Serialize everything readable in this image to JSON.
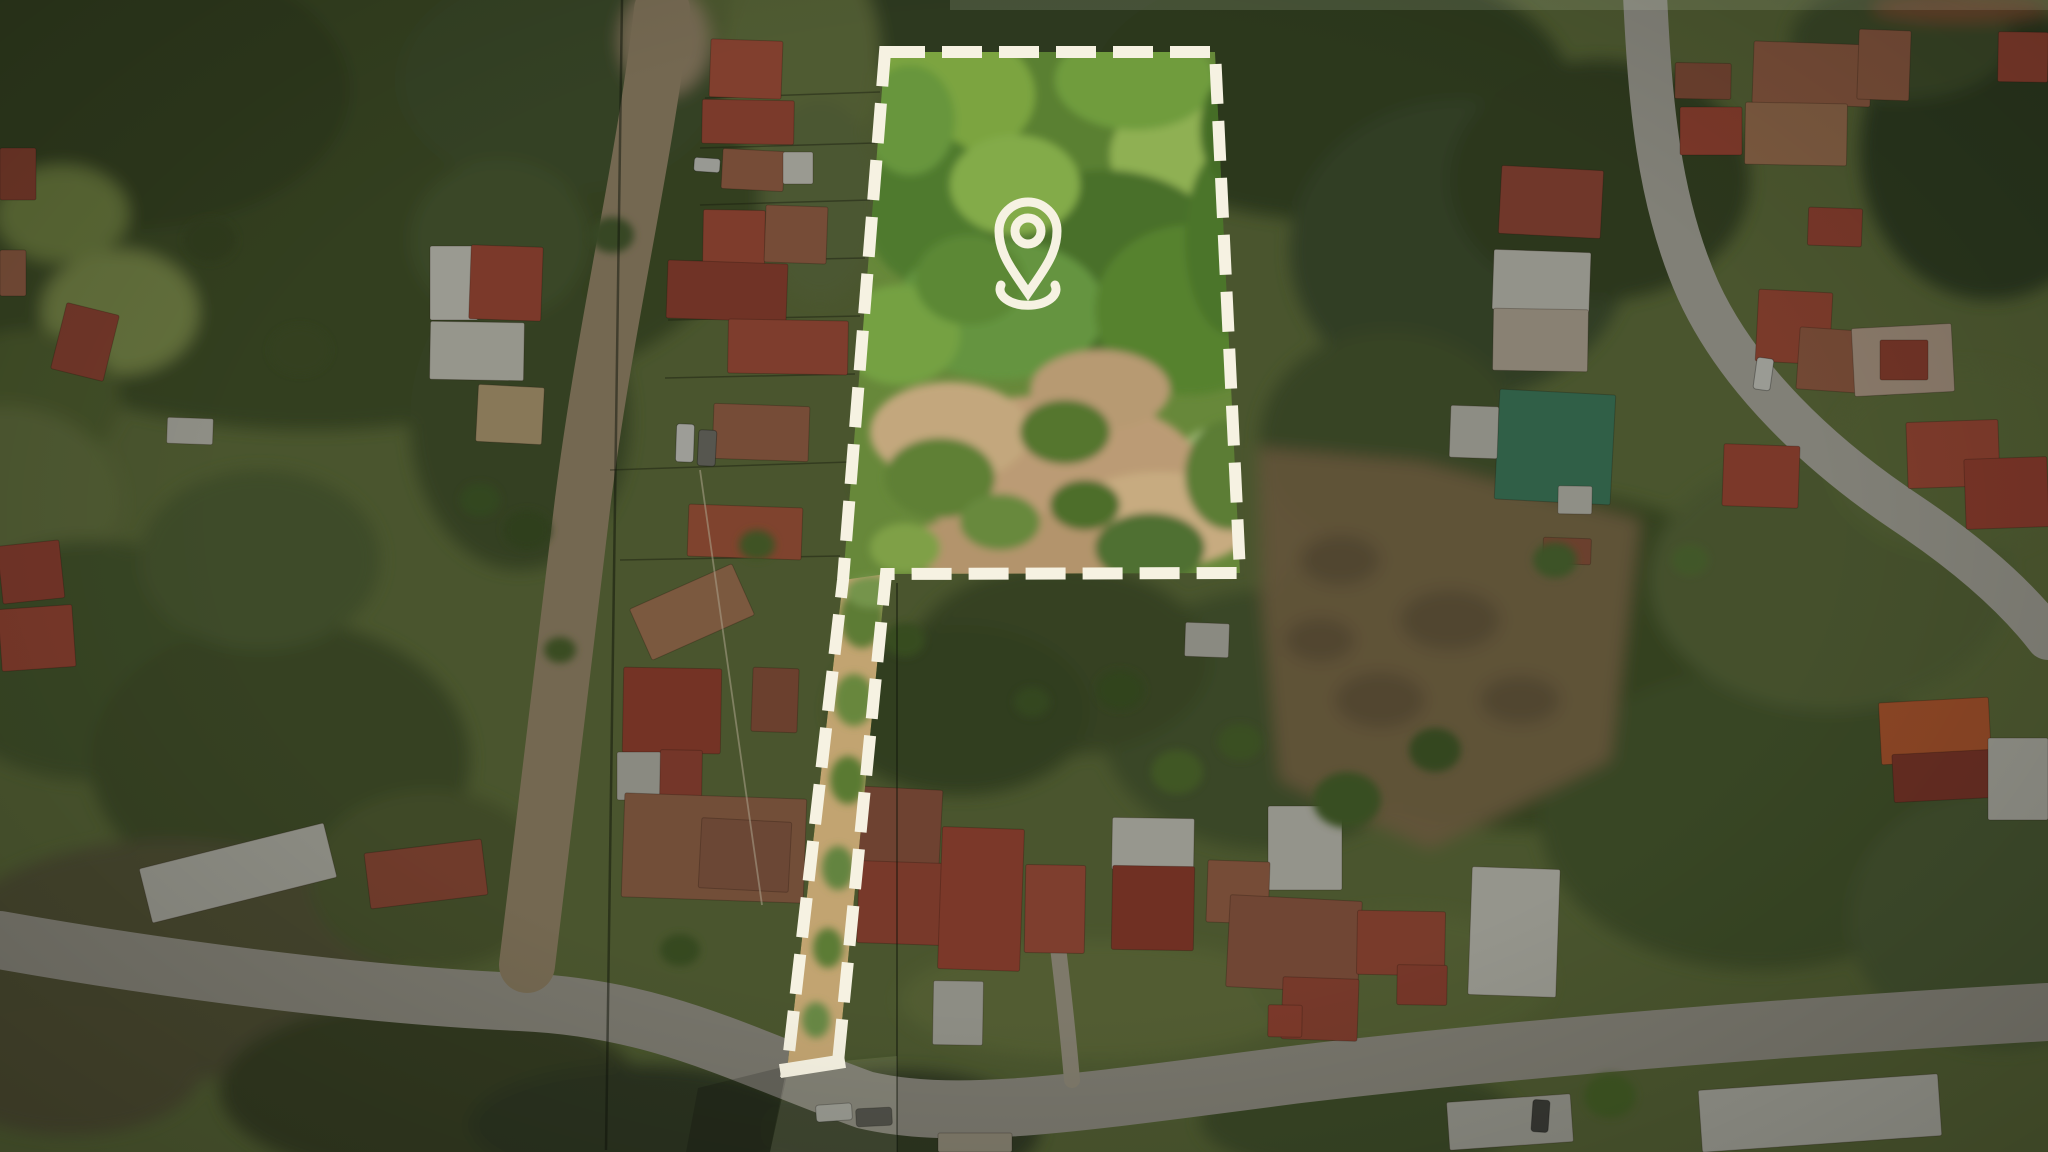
{
  "meta": {
    "type": "aerial-drone-photograph",
    "subject": "rural neighborhood with marked property parcel, location pin, dimmed surroundings"
  },
  "canvas": {
    "w": 2048,
    "h": 1152
  },
  "palette": {
    "annotation_white": "#f6f2e2",
    "base_green": "#66753f",
    "parcel_green": "#67883a",
    "clearing_tan": "#bb9b74",
    "red_roof": "#b5553f",
    "rust_roof": "#a5684c",
    "white_roof": "#d9d7cd",
    "green_metal_roof": "#418363",
    "paved_road": "#b5b2a8",
    "gravel_road": "#a39072",
    "bottom_road": "#a7a297"
  },
  "annotation": {
    "boundary": {
      "color": "#f6f2e2",
      "stroke_width": 12,
      "dash": "40 17",
      "points": [
        [
          885,
          52
        ],
        [
          1215,
          52
        ],
        [
          1240,
          573
        ],
        [
          886,
          574
        ],
        [
          838,
          1062
        ],
        [
          787,
          1070
        ],
        [
          843,
          580
        ]
      ],
      "closing_bar": [
        787,
        1070,
        838,
        1062
      ],
      "closing_bar_width": 14
    },
    "pin": {
      "color": "#f6f2e2",
      "stroke_width": 9,
      "cx": 1028,
      "head_cy": 231,
      "head_r": 29,
      "hole_r": 13,
      "tip_y": 293,
      "base_arc": {
        "x1": 1001,
        "y1": 285,
        "rx": 28,
        "ry": 16,
        "x2": 1055,
        "y2": 285
      }
    }
  },
  "effects": {
    "outside_dim": "rgba(10,14,8,0.30)",
    "top_bright_strip": {
      "x": 950,
      "y": 0,
      "w": 1098,
      "h": 10,
      "fill": "rgba(235,238,215,0.14)"
    },
    "corridor": {
      "points": [
        [
          789,
          1066
        ],
        [
          897,
          1056
        ],
        [
          897,
          1152
        ],
        [
          770,
          1152
        ]
      ],
      "fill": "rgba(232,236,208,0.10)"
    },
    "dark_wedge": {
      "points": [
        [
          787,
          1066
        ],
        [
          770,
          1152
        ],
        [
          686,
          1152
        ],
        [
          698,
          1088
        ]
      ],
      "fill": "rgba(0,0,0,0.16)"
    }
  },
  "terrain": {
    "base": "#66753f",
    "patches": [
      [
        310,
        170,
        460,
        260,
        "#44542c"
      ],
      [
        120,
        90,
        230,
        140,
        "#3c4c28"
      ],
      [
        560,
        80,
        160,
        110,
        "#475830"
      ],
      [
        62,
        214,
        66,
        48,
        "#7e9148"
      ],
      [
        120,
        312,
        78,
        62,
        "#8a9b52"
      ],
      [
        30,
        400,
        90,
        70,
        "#5a6a36"
      ],
      [
        0,
        500,
        120,
        95,
        "#6d7c44"
      ],
      [
        90,
        660,
        160,
        120,
        "#4e5f33"
      ],
      [
        280,
        760,
        190,
        140,
        "#49592f"
      ],
      [
        170,
        960,
        230,
        120,
        "#5d5c3e"
      ],
      [
        430,
        1090,
        210,
        90,
        "#424c2c"
      ],
      [
        640,
        1125,
        170,
        60,
        "#38422a"
      ],
      [
        520,
        420,
        110,
        150,
        "#46562d"
      ],
      [
        500,
        240,
        90,
        80,
        "#506134"
      ],
      [
        1040,
        25,
        320,
        55,
        "#3e4e2a"
      ],
      [
        1330,
        90,
        240,
        130,
        "#3b4b28"
      ],
      [
        1460,
        250,
        170,
        150,
        "#425230"
      ],
      [
        1390,
        440,
        130,
        110,
        "#4b5b31"
      ],
      [
        1530,
        660,
        280,
        170,
        "#465829"
      ],
      [
        1760,
        820,
        220,
        150,
        "#4d5e33"
      ],
      [
        2000,
        920,
        150,
        130,
        "#55663a"
      ],
      [
        1270,
        720,
        170,
        130,
        "#4f6134"
      ],
      [
        1060,
        660,
        150,
        95,
        "#48592d"
      ],
      [
        960,
        710,
        130,
        85,
        "#42532a"
      ],
      [
        1600,
        180,
        150,
        120,
        "#3a4a27"
      ],
      [
        1990,
        150,
        130,
        150,
        "#354526"
      ],
      [
        1830,
        580,
        180,
        130,
        "#5e6e3c"
      ],
      [
        1960,
        460,
        130,
        95,
        "#66763f"
      ],
      [
        900,
        1130,
        140,
        60,
        "#3b452b"
      ],
      [
        70,
        1070,
        130,
        65,
        "#5e5c3d"
      ],
      [
        1900,
        40,
        110,
        60,
        "#4a5a30"
      ],
      [
        1360,
        1120,
        160,
        55,
        "#4b5c31"
      ],
      [
        260,
        560,
        120,
        90,
        "#556637"
      ],
      [
        430,
        880,
        120,
        90,
        "#566334"
      ],
      [
        800,
        60,
        80,
        120,
        "#6e7d45"
      ],
      [
        820,
        200,
        60,
        100,
        "#687744"
      ],
      [
        1100,
        1000,
        200,
        60,
        "#717f45"
      ],
      [
        1400,
        980,
        150,
        70,
        "#6c7a42"
      ],
      [
        665,
        40,
        45,
        55,
        "#a39072"
      ],
      [
        1960,
        8,
        88,
        14,
        "#8a5a38"
      ]
    ],
    "clearing": {
      "points": [
        [
          1258,
          448
        ],
        [
          1420,
          462
        ],
        [
          1640,
          520
        ],
        [
          1610,
          760
        ],
        [
          1430,
          850
        ],
        [
          1280,
          780
        ],
        [
          1262,
          600
        ]
      ],
      "fill": "#8a7350",
      "speckles": [
        [
          1340,
          560,
          40,
          25,
          "#6b5a40"
        ],
        [
          1450,
          620,
          50,
          30,
          "#6b5a40"
        ],
        [
          1380,
          700,
          45,
          28,
          "#6b5a40"
        ],
        [
          1520,
          700,
          40,
          24,
          "#6b5a40"
        ],
        [
          1320,
          640,
          35,
          22,
          "#6b5a40"
        ]
      ]
    }
  },
  "parcel": {
    "base": "#67883a",
    "points": [
      [
        885,
        52
      ],
      [
        1215,
        52
      ],
      [
        1240,
        573
      ],
      [
        886,
        574
      ],
      [
        838,
        1062
      ],
      [
        787,
        1070
      ],
      [
        843,
        580
      ]
    ],
    "strip": {
      "points": [
        [
          843,
          580
        ],
        [
          886,
          574
        ],
        [
          838,
          1062
        ],
        [
          787,
          1070
        ]
      ],
      "fill": "#c2a471"
    },
    "patches": [
      [
        1060,
        130,
        190,
        115,
        "#5a8031"
      ],
      [
        950,
        95,
        85,
        65,
        "#7ca43f"
      ],
      [
        1185,
        155,
        75,
        60,
        "#8fb053"
      ],
      [
        930,
        210,
        65,
        75,
        "#4f7a2e"
      ],
      [
        1105,
        265,
        125,
        95,
        "#49702c"
      ],
      [
        1000,
        310,
        105,
        70,
        "#659441"
      ],
      [
        1190,
        310,
        95,
        85,
        "#57822f"
      ],
      [
        900,
        335,
        60,
        50,
        "#74a143"
      ],
      [
        1230,
        240,
        45,
        95,
        "#4c742b"
      ],
      [
        1015,
        185,
        65,
        50,
        "#83ab4a"
      ],
      [
        1135,
        80,
        80,
        50,
        "#6f9c3e"
      ],
      [
        970,
        280,
        55,
        45,
        "#5c8836"
      ],
      [
        1240,
        130,
        40,
        60,
        "#456d28"
      ],
      [
        910,
        120,
        45,
        55,
        "#68963c"
      ],
      [
        1213,
        450,
        30,
        22,
        "#9ab470"
      ],
      [
        1050,
        470,
        150,
        75,
        "#bb9b74"
      ],
      [
        950,
        432,
        80,
        50,
        "#c3a77d"
      ],
      [
        1160,
        520,
        95,
        48,
        "#c7ab80"
      ],
      [
        1020,
        548,
        120,
        36,
        "#b3946c"
      ],
      [
        1100,
        390,
        70,
        40,
        "#b79a72"
      ],
      [
        940,
        478,
        55,
        40,
        "#5e8034"
      ],
      [
        1065,
        432,
        45,
        32,
        "#54762f"
      ],
      [
        1150,
        548,
        55,
        35,
        "#4f7030"
      ],
      [
        905,
        548,
        35,
        25,
        "#7fa047"
      ],
      [
        1230,
        475,
        45,
        55,
        "#5b7d36"
      ],
      [
        1000,
        522,
        40,
        28,
        "#68893c"
      ],
      [
        1085,
        505,
        35,
        25,
        "#4d6e2c"
      ],
      [
        862,
        618,
        22,
        30,
        "#5d7c36"
      ],
      [
        854,
        700,
        20,
        26,
        "#67873c"
      ],
      [
        848,
        780,
        18,
        24,
        "#5a7a33"
      ],
      [
        838,
        868,
        16,
        22,
        "#648440"
      ],
      [
        828,
        948,
        15,
        20,
        "#5b7b35"
      ],
      [
        816,
        1020,
        14,
        18,
        "#688844"
      ],
      [
        872,
        592,
        26,
        16,
        "#74944c"
      ]
    ]
  },
  "roads": [
    {
      "name": "bottom-road",
      "d": "M0,940 C180,972 380,996 520,1002 C660,1008 740,1055 865,1100 C960,1122 1080,1102 1300,1074 C1520,1048 1800,1026 2048,1012",
      "color": "#a7a297",
      "width": 58
    },
    {
      "name": "left-gravel-road",
      "d": "M662,10 C645,160 606,320 583,500 C563,660 543,820 527,965",
      "color": "#a39072",
      "width": 56
    },
    {
      "name": "right-paved-road",
      "d": "M1645,-5 C1650,100 1658,200 1698,290 C1738,378 1820,455 1905,512 C1965,552 2015,595 2048,638",
      "color": "#b5b2a8",
      "width": 44
    },
    {
      "name": "driveway",
      "d": "M1072,1080 C1066,1010 1060,965 1056,930",
      "color": "#b0a895",
      "width": 16
    }
  ],
  "fences": [
    [
      705,
      98,
      880,
      92
    ],
    [
      700,
      148,
      875,
      143
    ],
    [
      700,
      205,
      870,
      200
    ],
    [
      670,
      262,
      865,
      258
    ],
    [
      668,
      320,
      860,
      316
    ],
    [
      665,
      378,
      855,
      374
    ],
    [
      610,
      470,
      850,
      462
    ],
    [
      620,
      560,
      840,
      556
    ]
  ],
  "houses": [
    [
      710,
      40,
      72,
      58,
      2,
      "#b5553f"
    ],
    [
      702,
      100,
      92,
      44,
      1,
      "#ad4e3b"
    ],
    [
      722,
      150,
      62,
      40,
      3,
      "#a5684c"
    ],
    [
      783,
      152,
      30,
      32,
      0,
      "#d9d7cd"
    ],
    [
      703,
      210,
      62,
      54,
      1,
      "#b0513d"
    ],
    [
      765,
      206,
      62,
      57,
      2,
      "#a5684c"
    ],
    [
      667,
      262,
      120,
      58,
      2,
      "#9d4434"
    ],
    [
      728,
      320,
      120,
      54,
      1,
      "#b0523e"
    ],
    [
      713,
      405,
      96,
      55,
      2,
      "#a5684c"
    ],
    [
      688,
      506,
      114,
      52,
      2,
      "#b25b3f"
    ],
    [
      636,
      584,
      112,
      56,
      -24,
      "#ad7a58"
    ],
    [
      623,
      668,
      98,
      85,
      1,
      "#a34433"
    ],
    [
      752,
      668,
      46,
      64,
      2,
      "#96573f"
    ],
    [
      617,
      752,
      44,
      48,
      0,
      "#c2c0b6"
    ],
    [
      660,
      750,
      42,
      50,
      1,
      "#a34838"
    ],
    [
      623,
      796,
      182,
      104,
      2,
      "#a06a4e"
    ],
    [
      700,
      820,
      90,
      70,
      3,
      "#96604a"
    ],
    [
      430,
      246,
      48,
      74,
      0,
      "#d9d7cd"
    ],
    [
      470,
      246,
      72,
      74,
      2,
      "#ad4d3a"
    ],
    [
      430,
      322,
      94,
      58,
      1,
      "#d3d1c6"
    ],
    [
      477,
      386,
      66,
      57,
      3,
      "#bfa77c"
    ],
    [
      58,
      308,
      54,
      68,
      14,
      "#a04a38"
    ],
    [
      167,
      418,
      46,
      26,
      2,
      "#c9c7bd"
    ],
    [
      0,
      543,
      62,
      58,
      -6,
      "#a34737"
    ],
    [
      0,
      607,
      74,
      62,
      -4,
      "#ab4c3a"
    ],
    [
      143,
      845,
      190,
      56,
      -14,
      "#c6c4ba"
    ],
    [
      367,
      846,
      118,
      56,
      -7,
      "#9d4f3c"
    ],
    [
      0,
      148,
      36,
      52,
      0,
      "#9a4836"
    ],
    [
      0,
      250,
      26,
      46,
      0,
      "#a5684c"
    ],
    [
      853,
      788,
      88,
      76,
      3,
      "#9a5a44"
    ],
    [
      858,
      862,
      84,
      82,
      2,
      "#a84c3a"
    ],
    [
      940,
      828,
      82,
      142,
      2,
      "#ad4b38"
    ],
    [
      1025,
      865,
      60,
      88,
      1,
      "#b05340"
    ],
    [
      1112,
      818,
      82,
      52,
      1,
      "#d5d3c9"
    ],
    [
      1112,
      866,
      82,
      84,
      1,
      "#9c3f30"
    ],
    [
      1268,
      806,
      74,
      84,
      0,
      "#d0cec4"
    ],
    [
      1207,
      861,
      62,
      62,
      2,
      "#a5684c"
    ],
    [
      1228,
      898,
      132,
      92,
      3,
      "#9d5f48"
    ],
    [
      1282,
      978,
      76,
      62,
      2,
      "#a54c3a"
    ],
    [
      1357,
      911,
      88,
      64,
      1,
      "#aa4f3b"
    ],
    [
      1397,
      965,
      50,
      40,
      1,
      "#a54a38"
    ],
    [
      933,
      981,
      50,
      64,
      1,
      "#c6c4ba"
    ],
    [
      1268,
      1005,
      34,
      32,
      1,
      "#ad4d3a"
    ],
    [
      1470,
      868,
      88,
      128,
      2,
      "#d2d0c6"
    ],
    [
      1185,
      623,
      44,
      34,
      2,
      "#c2c0b6"
    ],
    [
      1753,
      43,
      118,
      62,
      2,
      "#a5684c"
    ],
    [
      1745,
      103,
      102,
      62,
      1,
      "#ad7a58"
    ],
    [
      1675,
      63,
      56,
      36,
      1,
      "#96573f"
    ],
    [
      1680,
      107,
      62,
      48,
      0,
      "#ad4b38"
    ],
    [
      1500,
      168,
      102,
      68,
      3,
      "#9d4a3a"
    ],
    [
      1493,
      251,
      97,
      60,
      2,
      "#cfcdc3"
    ],
    [
      1493,
      309,
      95,
      62,
      1,
      "#c0b4a2"
    ],
    [
      1808,
      208,
      54,
      38,
      2,
      "#a84939"
    ],
    [
      1757,
      291,
      74,
      72,
      3,
      "#ab4e3a"
    ],
    [
      1798,
      330,
      92,
      62,
      4,
      "#a06248"
    ],
    [
      1497,
      392,
      116,
      110,
      3,
      "#418363"
    ],
    [
      1450,
      406,
      48,
      52,
      2,
      "#c6c4ba"
    ],
    [
      1558,
      486,
      34,
      28,
      1,
      "#c9c7bd"
    ],
    [
      1543,
      538,
      48,
      26,
      2,
      "#96573f"
    ],
    [
      1723,
      445,
      76,
      62,
      2,
      "#ad4b38"
    ],
    [
      1853,
      326,
      100,
      68,
      -3,
      "#c0a894"
    ],
    [
      1880,
      340,
      48,
      40,
      0,
      "#9c4434"
    ],
    [
      1907,
      421,
      92,
      66,
      -2,
      "#b0503c"
    ],
    [
      1965,
      458,
      83,
      70,
      -2,
      "#a84636"
    ],
    [
      1880,
      700,
      110,
      62,
      -3,
      "#c45f33"
    ],
    [
      1893,
      752,
      100,
      48,
      -3,
      "#8f3b2e"
    ],
    [
      1988,
      738,
      60,
      82,
      0,
      "#cbc9bf"
    ],
    [
      1858,
      30,
      52,
      70,
      2,
      "#a5684c"
    ],
    [
      1998,
      32,
      50,
      50,
      1,
      "#ad4d3a"
    ],
    [
      1700,
      1082,
      240,
      62,
      -4,
      "#cfcdc3"
    ],
    [
      1448,
      1098,
      124,
      48,
      -4,
      "#c2c0b6"
    ],
    [
      938,
      1133,
      74,
      19,
      0,
      "#b0a894"
    ]
  ],
  "trees": [
    [
      1177,
      772,
      26,
      22,
      "#587733"
    ],
    [
      1347,
      800,
      34,
      28,
      "#4e6b2d"
    ],
    [
      1610,
      1096,
      26,
      22,
      "#55742f"
    ],
    [
      905,
      640,
      20,
      17,
      "#4c672c"
    ],
    [
      527,
      530,
      24,
      20,
      "#3f5526"
    ],
    [
      757,
      545,
      18,
      15,
      "#567231"
    ],
    [
      1032,
      702,
      18,
      15,
      "#47612a"
    ],
    [
      1240,
      742,
      22,
      18,
      "#506c2e"
    ],
    [
      680,
      950,
      20,
      16,
      "#4a6329"
    ],
    [
      560,
      650,
      16,
      13,
      "#50682e"
    ],
    [
      480,
      500,
      20,
      17,
      "#45602a"
    ],
    [
      1120,
      690,
      24,
      20,
      "#435c28"
    ],
    [
      1435,
      750,
      26,
      22,
      "#46612b"
    ],
    [
      1555,
      560,
      22,
      18,
      "#527134"
    ],
    [
      1690,
      560,
      18,
      15,
      "#5a7838"
    ],
    [
      612,
      235,
      22,
      18,
      "#4b6030"
    ],
    [
      300,
      350,
      30,
      24,
      "#46572c"
    ],
    [
      210,
      240,
      26,
      22,
      "#3f5028"
    ],
    [
      866,
      480,
      16,
      20,
      "#557530"
    ]
  ],
  "cars": [
    [
      694,
      158,
      26,
      14,
      4,
      "#d6d6d0"
    ],
    [
      676,
      424,
      18,
      38,
      2,
      "#dddcd6"
    ],
    [
      698,
      430,
      18,
      36,
      3,
      "#77766f"
    ],
    [
      816,
      1104,
      36,
      17,
      -4,
      "#cbcbc5"
    ],
    [
      856,
      1108,
      36,
      18,
      -3,
      "#55544f"
    ],
    [
      1755,
      358,
      17,
      32,
      8,
      "#d8d8d2"
    ],
    [
      1532,
      1100,
      17,
      32,
      4,
      "#4a4a46"
    ]
  ],
  "cables": [
    [
      622,
      0,
      606,
      1150,
      "rgba(18,22,12,0.50)",
      2.5
    ],
    [
      897,
      583,
      897,
      1152,
      "rgba(18,22,12,0.45)",
      2
    ],
    [
      700,
      470,
      762,
      905,
      "rgba(242,228,198,0.55)",
      1.8
    ]
  ]
}
